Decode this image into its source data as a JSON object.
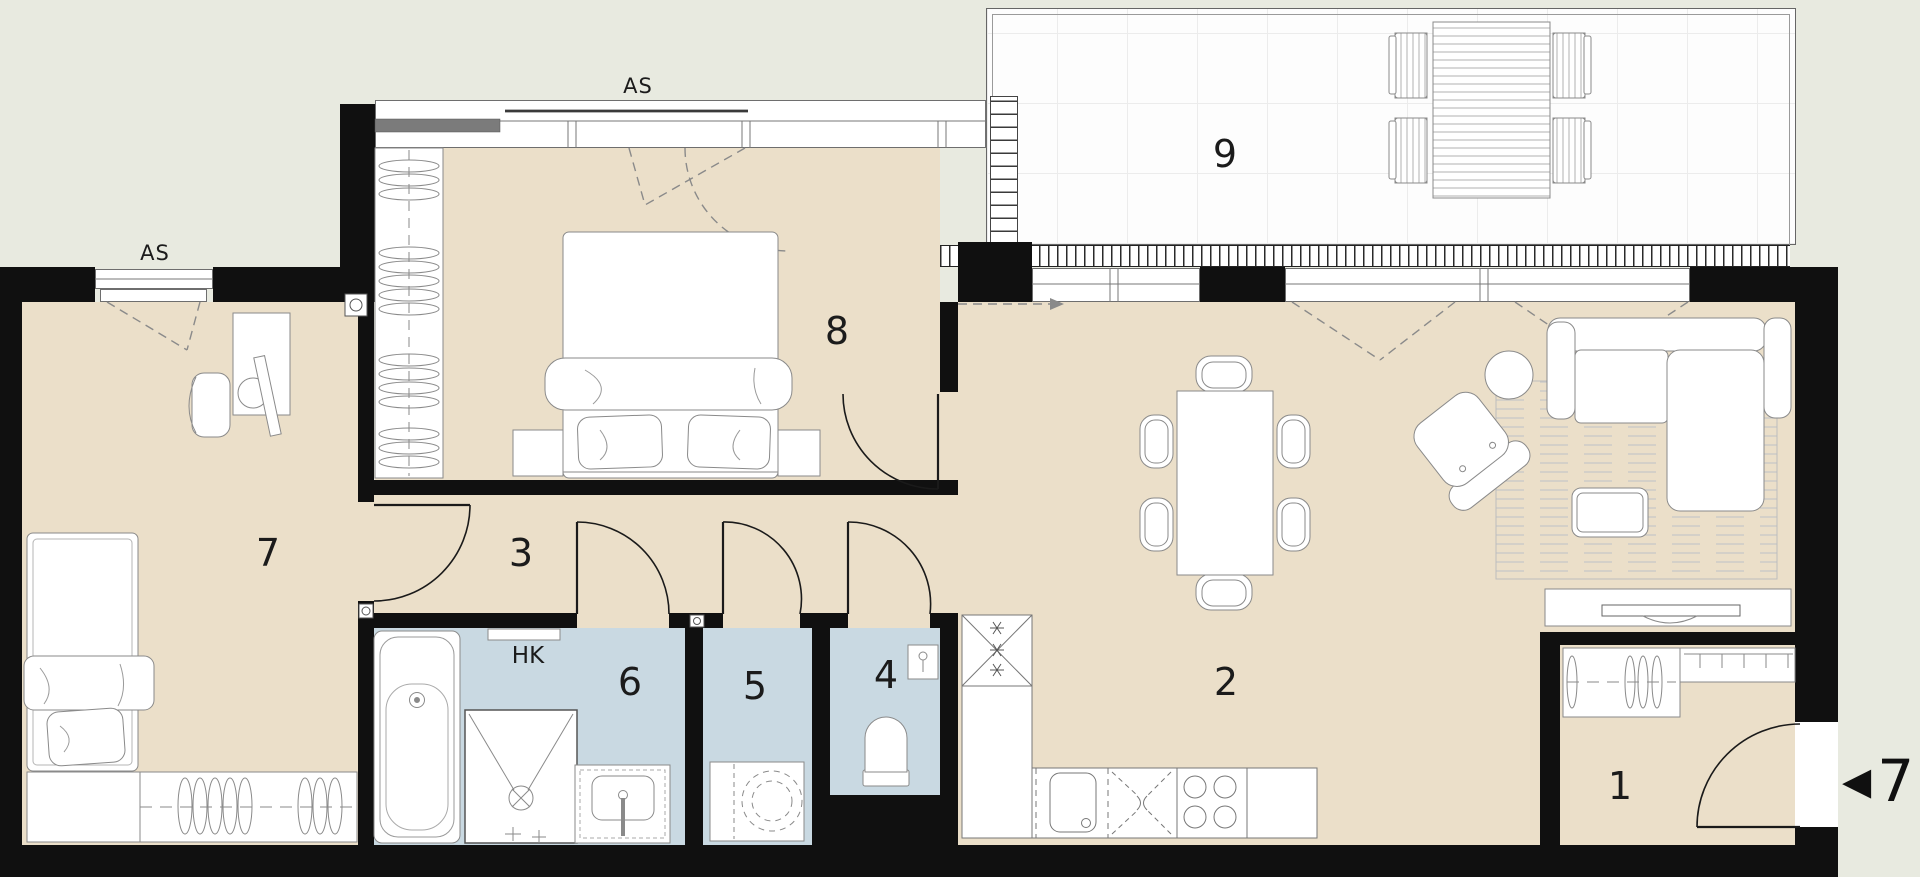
{
  "colors": {
    "background": "#e8eae0",
    "room_floor": "#ebdfc9",
    "wet_room_floor": "#c9d9e2",
    "wall": "#101010",
    "terrace_floor": "#fdfdfd",
    "furniture_line": "#8a8a8a"
  },
  "room_labels": {
    "r1": "1",
    "r2": "2",
    "r3": "3",
    "r4": "4",
    "r5": "5",
    "r6": "6",
    "r7": "7",
    "r8": "8",
    "r9": "9"
  },
  "annotations": {
    "window_label_top": "AS",
    "window_label_left": "AS",
    "bath_shelf_label": "HK"
  },
  "entrance_marker": {
    "arrow": "◀",
    "number": "7"
  }
}
